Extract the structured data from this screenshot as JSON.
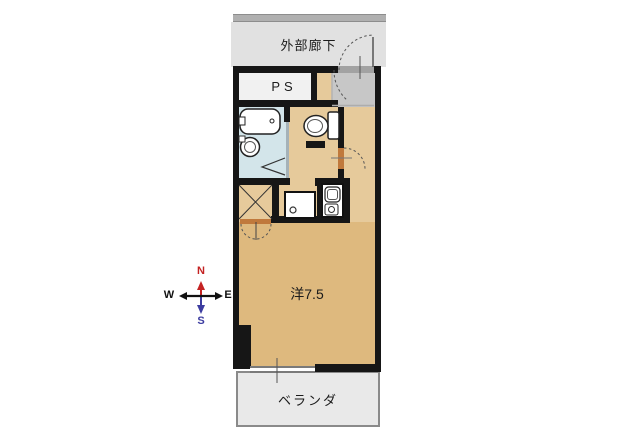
{
  "floorplan": {
    "corridor_label": "外部廊下",
    "ps_label": "PS",
    "main_room_label": "洋7.5",
    "balcony_label": "ベランダ",
    "compass": {
      "n": "N",
      "s": "S",
      "w": "W",
      "e": "E"
    },
    "colors": {
      "wall": "#161616",
      "external_corridor": "#e1e1e1",
      "top_rail": "#b0b0b0",
      "genkan_floor": "#c7c7c7",
      "hallway_floor": "#e6ca9b",
      "main_room_floor": "#deb97e",
      "bathroom_floor": "#d3e5ea",
      "ps_room": "#f1f1f1",
      "balcony": "#e9e9e9",
      "door_accent": "#c0793c",
      "compass_north": "#c42222",
      "compass_south": "#3c3ca0"
    },
    "fixtures": [
      "bathtub",
      "washbasin",
      "toilet",
      "washing-machine-pan",
      "kitchenette-sink",
      "stove-burner"
    ]
  }
}
